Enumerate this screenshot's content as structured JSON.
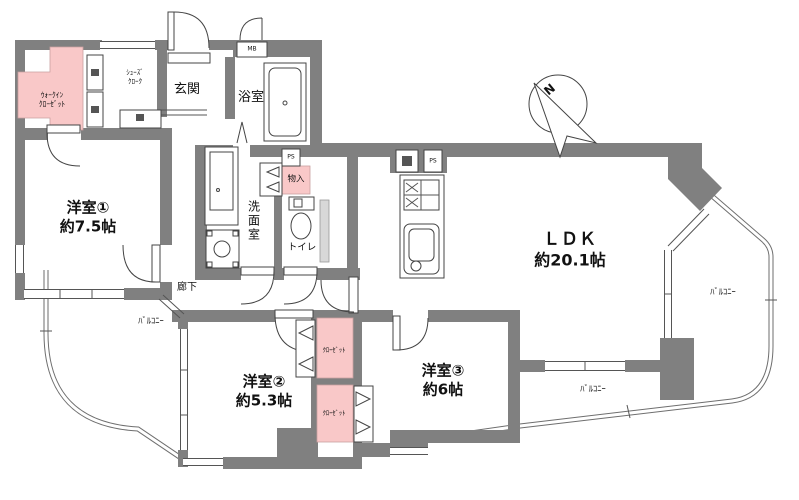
{
  "colors": {
    "wall": "#808080",
    "closet_pink": "#f9c8c8",
    "line": "#444444",
    "text": "#111111"
  },
  "rooms": {
    "room1": {
      "name": "洋室①",
      "size": "約7.5帖"
    },
    "room2": {
      "name": "洋室②",
      "size": "約5.3帖"
    },
    "room3": {
      "name": "洋室③",
      "size": "約6帖"
    },
    "ldk": {
      "name": "ＬＤＫ",
      "size": "約20.1帖"
    },
    "genkan": {
      "name": "玄関"
    },
    "bathroom": {
      "name": "浴室"
    },
    "washroom": {
      "name": "洗面室"
    },
    "toilet": {
      "name": "トイレ"
    },
    "corridor": {
      "name": "廊下"
    }
  },
  "storage": {
    "walk_in_closet": {
      "line1": "ｳｫｰｸｲﾝ",
      "line2": "ｸﾛｰｾﾞｯﾄ"
    },
    "shoes_cloak": {
      "line1": "ｼｭｰｽﾞ",
      "line2": "ｸﾛｰｸ"
    },
    "mono_ire": {
      "name": "物入"
    },
    "closet_upper": {
      "name": "ｸﾛｰｾﾞｯﾄ"
    },
    "closet_lower": {
      "name": "ｸﾛｰｾﾞｯﾄ"
    }
  },
  "balconies": {
    "left": "ﾊﾞﾙｺﾆｰ",
    "right": "ﾊﾞﾙｺﾆｰ",
    "bottom": "ﾊﾞﾙｺﾆｰ"
  },
  "utilities": {
    "mb": "MB",
    "ps_bath": "PS",
    "ps_kitchen": "PS"
  },
  "compass": {
    "north": "N"
  }
}
